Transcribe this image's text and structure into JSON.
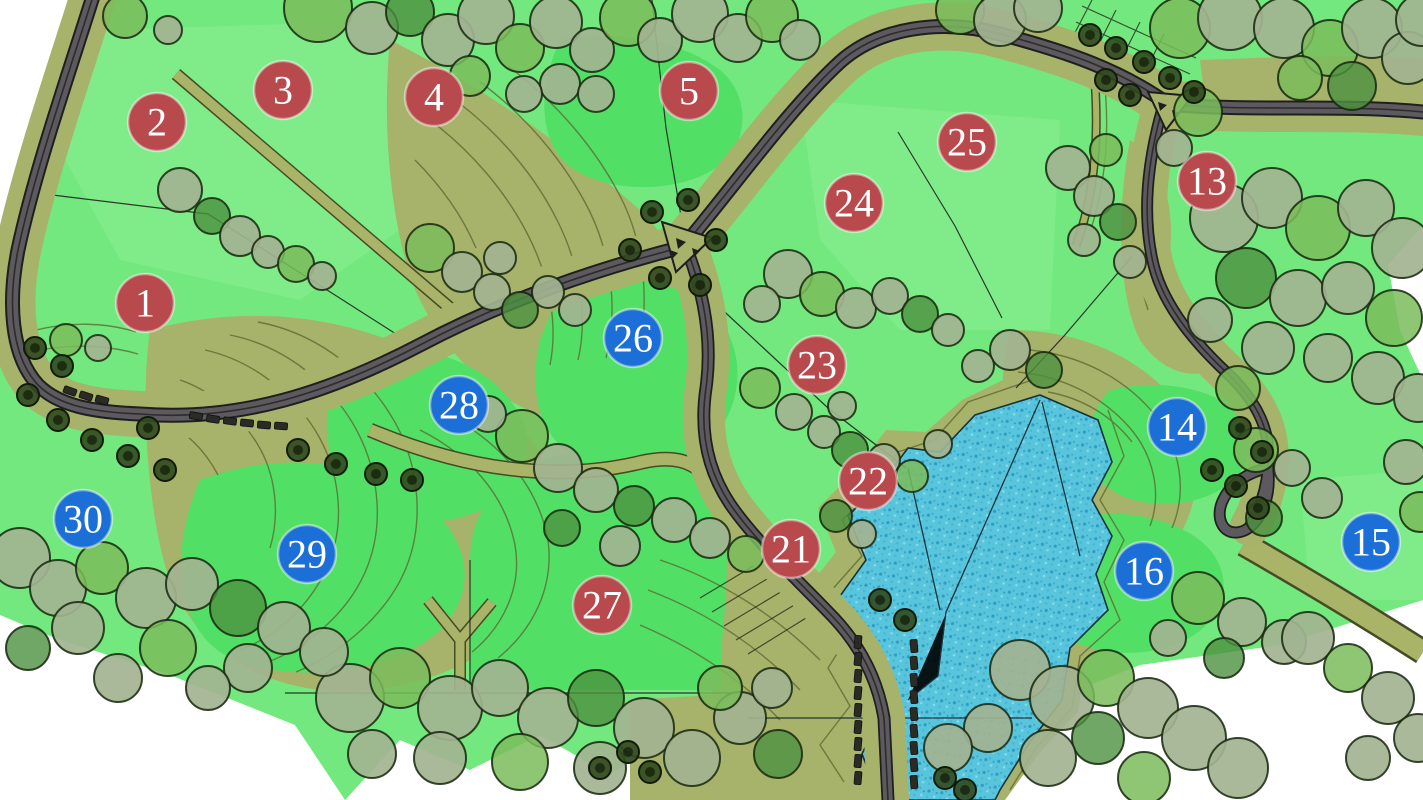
{
  "map_title": "landscape-master-plan",
  "colors": {
    "paper": "#ffffff",
    "lawn_base": "#72e87e",
    "lawn_bright": "#52df66",
    "lawn_light": "#8bee92",
    "terrain_khaki": "#a7b26a",
    "terrain_line": "#5c6430",
    "path_edge": "#454b22",
    "road_fill": "#5d5a5f",
    "road_casing": "#1f1f1f",
    "road_center": "#2d2b2d",
    "water_base": "#58c5dd",
    "water_dot_dark": "#2f9dc1",
    "water_dot_light": "#85dbe9",
    "water_outline": "#14323e",
    "tree_sage": "#a2b391",
    "tree_green": "#7abc5c",
    "tree_dark": "#4c9140",
    "tree_street": "#32491f",
    "tree_outline": "#16270e",
    "marker_red": "#b84a4d",
    "marker_blue": "#1d6fd8",
    "marker_text": "#ffffff",
    "car": "#2b2b25"
  },
  "markers": [
    {
      "label": "1",
      "color": "red",
      "x": 145,
      "y": 303
    },
    {
      "label": "2",
      "color": "red",
      "x": 157,
      "y": 122
    },
    {
      "label": "3",
      "color": "red",
      "x": 283,
      "y": 90
    },
    {
      "label": "4",
      "color": "red",
      "x": 434,
      "y": 97
    },
    {
      "label": "5",
      "color": "red",
      "x": 689,
      "y": 91
    },
    {
      "label": "13",
      "color": "red",
      "x": 1207,
      "y": 181
    },
    {
      "label": "14",
      "color": "blue",
      "x": 1177,
      "y": 427
    },
    {
      "label": "15",
      "color": "blue",
      "x": 1371,
      "y": 542
    },
    {
      "label": "16",
      "color": "blue",
      "x": 1144,
      "y": 571
    },
    {
      "label": "21",
      "color": "red",
      "x": 791,
      "y": 549
    },
    {
      "label": "22",
      "color": "red",
      "x": 868,
      "y": 481
    },
    {
      "label": "23",
      "color": "red",
      "x": 817,
      "y": 365
    },
    {
      "label": "24",
      "color": "red",
      "x": 854,
      "y": 203
    },
    {
      "label": "25",
      "color": "red",
      "x": 967,
      "y": 142
    },
    {
      "label": "26",
      "color": "blue",
      "x": 633,
      "y": 338
    },
    {
      "label": "27",
      "color": "red",
      "x": 602,
      "y": 605
    },
    {
      "label": "28",
      "color": "blue",
      "x": 459,
      "y": 405
    },
    {
      "label": "29",
      "color": "blue",
      "x": 307,
      "y": 554
    },
    {
      "label": "30",
      "color": "blue",
      "x": 83,
      "y": 519
    }
  ],
  "marker_radius": 29,
  "trees": [
    [
      318,
      8,
      34,
      "g"
    ],
    [
      372,
      28,
      26,
      "s"
    ],
    [
      410,
      12,
      24,
      "d"
    ],
    [
      448,
      40,
      26,
      "s"
    ],
    [
      486,
      16,
      28,
      "s"
    ],
    [
      520,
      48,
      24,
      "g"
    ],
    [
      556,
      22,
      26,
      "s"
    ],
    [
      592,
      50,
      22,
      "s"
    ],
    [
      628,
      18,
      28,
      "g"
    ],
    [
      560,
      84,
      20,
      "s"
    ],
    [
      596,
      94,
      18,
      "s"
    ],
    [
      524,
      94,
      18,
      "s"
    ],
    [
      470,
      76,
      20,
      "g"
    ],
    [
      660,
      40,
      22,
      "s"
    ],
    [
      700,
      14,
      28,
      "s"
    ],
    [
      738,
      38,
      24,
      "s"
    ],
    [
      772,
      16,
      26,
      "g"
    ],
    [
      800,
      40,
      20,
      "s"
    ],
    [
      125,
      16,
      22,
      "g"
    ],
    [
      168,
      30,
      14,
      "s"
    ],
    [
      960,
      10,
      24,
      "g"
    ],
    [
      1000,
      20,
      26,
      "s"
    ],
    [
      1038,
      8,
      24,
      "s"
    ],
    [
      1180,
      28,
      30,
      "g"
    ],
    [
      1230,
      18,
      32,
      "s"
    ],
    [
      1284,
      28,
      30,
      "s"
    ],
    [
      1330,
      48,
      28,
      "g"
    ],
    [
      1372,
      28,
      30,
      "s"
    ],
    [
      1408,
      58,
      26,
      "s"
    ],
    [
      1352,
      86,
      24,
      "d"
    ],
    [
      1300,
      78,
      22,
      "g"
    ],
    [
      1422,
      20,
      26,
      "s"
    ],
    [
      1068,
      168,
      22,
      "s"
    ],
    [
      1094,
      196,
      20,
      "s"
    ],
    [
      1118,
      222,
      18,
      "d"
    ],
    [
      1084,
      240,
      16,
      "s"
    ],
    [
      1106,
      150,
      16,
      "g"
    ],
    [
      1130,
      262,
      16,
      "s"
    ],
    [
      788,
      274,
      24,
      "s"
    ],
    [
      822,
      294,
      22,
      "g"
    ],
    [
      856,
      308,
      20,
      "s"
    ],
    [
      890,
      296,
      18,
      "s"
    ],
    [
      920,
      314,
      18,
      "d"
    ],
    [
      762,
      304,
      18,
      "s"
    ],
    [
      948,
      330,
      16,
      "s"
    ],
    [
      1010,
      350,
      20,
      "s"
    ],
    [
      1044,
      370,
      18,
      "d"
    ],
    [
      978,
      366,
      16,
      "s"
    ],
    [
      180,
      190,
      22,
      "s"
    ],
    [
      212,
      216,
      18,
      "d"
    ],
    [
      240,
      236,
      20,
      "s"
    ],
    [
      268,
      252,
      16,
      "s"
    ],
    [
      296,
      264,
      18,
      "g"
    ],
    [
      322,
      276,
      14,
      "s"
    ],
    [
      66,
      340,
      16,
      "g"
    ],
    [
      98,
      348,
      13,
      "s"
    ],
    [
      430,
      248,
      24,
      "g"
    ],
    [
      462,
      272,
      20,
      "s"
    ],
    [
      492,
      292,
      18,
      "s"
    ],
    [
      520,
      310,
      18,
      "d"
    ],
    [
      548,
      292,
      16,
      "s"
    ],
    [
      500,
      258,
      16,
      "s"
    ],
    [
      575,
      310,
      16,
      "s"
    ],
    [
      522,
      436,
      26,
      "g"
    ],
    [
      558,
      468,
      24,
      "s"
    ],
    [
      596,
      490,
      22,
      "s"
    ],
    [
      634,
      506,
      20,
      "d"
    ],
    [
      674,
      520,
      22,
      "s"
    ],
    [
      710,
      538,
      20,
      "s"
    ],
    [
      746,
      554,
      18,
      "g"
    ],
    [
      620,
      546,
      20,
      "s"
    ],
    [
      562,
      528,
      18,
      "d"
    ],
    [
      488,
      414,
      18,
      "s"
    ],
    [
      760,
      388,
      20,
      "g"
    ],
    [
      794,
      412,
      18,
      "s"
    ],
    [
      824,
      432,
      16,
      "s"
    ],
    [
      850,
      450,
      18,
      "d"
    ],
    [
      884,
      460,
      16,
      "s"
    ],
    [
      912,
      476,
      16,
      "g"
    ],
    [
      842,
      406,
      14,
      "s"
    ],
    [
      938,
      444,
      14,
      "s"
    ],
    [
      836,
      516,
      16,
      "d"
    ],
    [
      862,
      534,
      14,
      "s"
    ],
    [
      1224,
      218,
      34,
      "s"
    ],
    [
      1272,
      198,
      30,
      "s"
    ],
    [
      1318,
      228,
      32,
      "g"
    ],
    [
      1366,
      208,
      28,
      "s"
    ],
    [
      1402,
      248,
      30,
      "s"
    ],
    [
      1246,
      278,
      30,
      "d"
    ],
    [
      1298,
      298,
      28,
      "s"
    ],
    [
      1348,
      288,
      26,
      "s"
    ],
    [
      1394,
      318,
      28,
      "g"
    ],
    [
      1268,
      348,
      26,
      "s"
    ],
    [
      1328,
      358,
      24,
      "s"
    ],
    [
      1378,
      378,
      26,
      "s"
    ],
    [
      1418,
      398,
      24,
      "s"
    ],
    [
      1238,
      388,
      22,
      "g"
    ],
    [
      1198,
      112,
      24,
      "g"
    ],
    [
      1174,
      148,
      18,
      "s"
    ],
    [
      1210,
      320,
      22,
      "s"
    ],
    [
      1256,
      450,
      22,
      "g"
    ],
    [
      1292,
      468,
      18,
      "s"
    ],
    [
      1322,
      498,
      20,
      "s"
    ],
    [
      1264,
      518,
      18,
      "d"
    ],
    [
      1406,
      462,
      22,
      "s"
    ],
    [
      1420,
      512,
      20,
      "g"
    ],
    [
      1198,
      598,
      26,
      "g"
    ],
    [
      1242,
      622,
      24,
      "s"
    ],
    [
      1284,
      642,
      22,
      "s"
    ],
    [
      1224,
      658,
      20,
      "d"
    ],
    [
      1168,
      638,
      18,
      "s"
    ],
    [
      1020,
      670,
      30,
      "s"
    ],
    [
      1062,
      698,
      32,
      "s"
    ],
    [
      1106,
      678,
      28,
      "g"
    ],
    [
      1148,
      708,
      30,
      "s"
    ],
    [
      1194,
      738,
      32,
      "s"
    ],
    [
      1238,
      768,
      30,
      "s"
    ],
    [
      1098,
      738,
      26,
      "d"
    ],
    [
      1048,
      758,
      28,
      "s"
    ],
    [
      1144,
      778,
      26,
      "g"
    ],
    [
      988,
      728,
      24,
      "s"
    ],
    [
      1308,
      638,
      26,
      "s"
    ],
    [
      1348,
      668,
      24,
      "g"
    ],
    [
      1388,
      698,
      26,
      "s"
    ],
    [
      1418,
      738,
      24,
      "s"
    ],
    [
      1368,
      758,
      22,
      "s"
    ],
    [
      350,
      698,
      34,
      "s"
    ],
    [
      400,
      678,
      30,
      "g"
    ],
    [
      450,
      708,
      32,
      "s"
    ],
    [
      500,
      688,
      28,
      "s"
    ],
    [
      548,
      718,
      30,
      "s"
    ],
    [
      596,
      698,
      28,
      "d"
    ],
    [
      644,
      728,
      30,
      "s"
    ],
    [
      692,
      758,
      28,
      "s"
    ],
    [
      600,
      768,
      26,
      "s"
    ],
    [
      520,
      762,
      28,
      "g"
    ],
    [
      440,
      758,
      26,
      "s"
    ],
    [
      372,
      754,
      24,
      "s"
    ],
    [
      740,
      718,
      26,
      "s"
    ],
    [
      778,
      754,
      24,
      "d"
    ],
    [
      720,
      688,
      22,
      "g"
    ],
    [
      772,
      688,
      20,
      "s"
    ],
    [
      948,
      748,
      24,
      "s"
    ],
    [
      20,
      558,
      30,
      "s"
    ],
    [
      58,
      588,
      28,
      "s"
    ],
    [
      102,
      568,
      26,
      "g"
    ],
    [
      146,
      598,
      30,
      "s"
    ],
    [
      192,
      584,
      26,
      "s"
    ],
    [
      238,
      608,
      28,
      "d"
    ],
    [
      284,
      628,
      26,
      "s"
    ],
    [
      324,
      652,
      24,
      "s"
    ],
    [
      78,
      628,
      26,
      "s"
    ],
    [
      168,
      648,
      28,
      "g"
    ],
    [
      248,
      668,
      24,
      "s"
    ],
    [
      28,
      648,
      22,
      "d"
    ],
    [
      118,
      678,
      24,
      "s"
    ],
    [
      208,
      688,
      22,
      "s"
    ]
  ],
  "street_trees": [
    [
      35,
      348
    ],
    [
      62,
      366
    ],
    [
      28,
      395
    ],
    [
      58,
      420
    ],
    [
      92,
      440
    ],
    [
      128,
      456
    ],
    [
      165,
      470
    ],
    [
      298,
      450
    ],
    [
      336,
      464
    ],
    [
      376,
      474
    ],
    [
      412,
      480
    ],
    [
      148,
      428
    ],
    [
      652,
      212
    ],
    [
      688,
      200
    ],
    [
      716,
      240
    ],
    [
      700,
      285
    ],
    [
      660,
      278
    ],
    [
      630,
      250
    ],
    [
      1090,
      35
    ],
    [
      1116,
      48
    ],
    [
      1144,
      62
    ],
    [
      1170,
      78
    ],
    [
      1194,
      92
    ],
    [
      1106,
      80
    ],
    [
      1130,
      95
    ],
    [
      1240,
      428
    ],
    [
      1262,
      452
    ],
    [
      1236,
      486
    ],
    [
      1258,
      508
    ],
    [
      1212,
      470
    ],
    [
      628,
      752
    ],
    [
      650,
      772
    ],
    [
      600,
      768
    ],
    [
      945,
      778
    ],
    [
      965,
      790
    ],
    [
      905,
      620
    ],
    [
      880,
      600
    ]
  ],
  "parked_cars": [
    [
      70,
      391,
      20
    ],
    [
      86,
      396,
      18
    ],
    [
      102,
      400,
      16
    ],
    [
      196,
      416,
      10
    ],
    [
      213,
      419,
      9
    ],
    [
      230,
      421,
      8
    ],
    [
      247,
      423,
      6
    ],
    [
      264,
      425,
      5
    ],
    [
      281,
      426,
      4
    ],
    [
      858,
      642,
      95
    ],
    [
      858,
      659,
      95
    ],
    [
      858,
      676,
      95
    ],
    [
      858,
      693,
      95
    ],
    [
      858,
      710,
      95
    ],
    [
      858,
      727,
      95
    ],
    [
      858,
      744,
      95
    ],
    [
      858,
      761,
      95
    ],
    [
      858,
      778,
      95
    ],
    [
      914,
      646,
      85
    ],
    [
      914,
      663,
      85
    ],
    [
      914,
      680,
      85
    ],
    [
      914,
      697,
      85
    ],
    [
      914,
      714,
      85
    ],
    [
      914,
      731,
      85
    ],
    [
      914,
      748,
      85
    ],
    [
      914,
      765,
      85
    ],
    [
      914,
      782,
      85
    ]
  ]
}
